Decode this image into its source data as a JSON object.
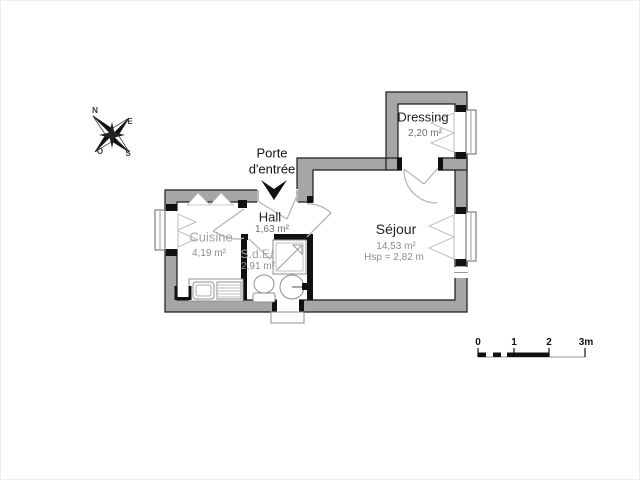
{
  "plan": {
    "entrance": {
      "label_line1": "Porte",
      "label_line2": "d'entrée"
    },
    "rooms": {
      "dressing": {
        "name": "Dressing",
        "area": "2,20 m²"
      },
      "sejour": {
        "name": "Séjour",
        "area": "14,53 m²",
        "ceiling_height": "Hsp = 2,82 m"
      },
      "hall": {
        "name": "Hall",
        "area": "1,63 m²"
      },
      "cuisine": {
        "name": "Cuisine",
        "area": "4,19 m²"
      },
      "sde": {
        "name": "S.d.E.",
        "area": "2,91 m²"
      }
    },
    "compass": {
      "north": "N",
      "east": "E",
      "south": "S",
      "west": "O"
    },
    "scale_bar": {
      "tick_labels": [
        "0",
        "1",
        "2",
        "3m"
      ],
      "unit_meters_per_segment": 1
    },
    "colors": {
      "wall_fill": "#a6a6a6",
      "wall_outline": "#1c1c1c",
      "interior_wall": "#111111",
      "fixture_line": "#8f8f8f",
      "door_line": "#b5b5b5",
      "room_label_dark": "#1f1f1f",
      "room_label_gray": "#a3a3a3",
      "area_label_gray": "#6f6f6f",
      "background": "#ffffff"
    }
  }
}
